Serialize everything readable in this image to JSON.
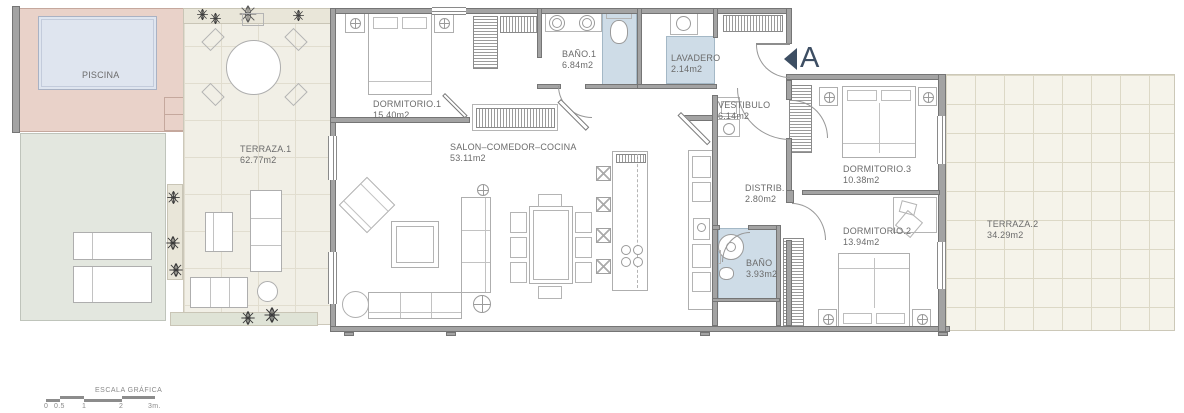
{
  "rooms": {
    "piscina": {
      "name": "PISCINA"
    },
    "terraza1": {
      "name": "TERRAZA.1",
      "area": "62.77m2"
    },
    "dormitorio1": {
      "name": "DORMITORIO.1",
      "area": "15.40m2"
    },
    "bano1": {
      "name": "BAÑO.1",
      "area": "6.84m2"
    },
    "lavadero": {
      "name": "LAVADERO",
      "area": "2.14m2"
    },
    "vestibulo": {
      "name": "VESTIBULO",
      "area": "6.14m2"
    },
    "salon": {
      "name": "SALON–COMEDOR–COCINA",
      "area": "53.11m2"
    },
    "distrib": {
      "name": "DISTRIB.",
      "area": "2.80m2"
    },
    "bano2": {
      "name": "BAÑO",
      "area": "3.93m2"
    },
    "dormitorio3": {
      "name": "DORMITORIO.3",
      "area": "10.38m2"
    },
    "dormitorio2": {
      "name": "DORMITORIO.2",
      "area": "13.94m2"
    },
    "terraza2": {
      "name": "TERRAZA.2",
      "area": "34.29m2"
    }
  },
  "markers": {
    "section_a": "A"
  },
  "scale_bar": {
    "title": "ESCALA GRÁFICA",
    "ticks": [
      "0",
      "0.5",
      "1",
      "2",
      "3m."
    ]
  },
  "colors": {
    "accent_navy": "#3d4e63",
    "pool_water": "#dfe5ef",
    "pool_deck": "#e9d2c9",
    "wet_room": "#cedce7",
    "terrace_tile": "#f1efe6",
    "lawn": "#e3e7df",
    "wall": "#a3a3a3"
  }
}
